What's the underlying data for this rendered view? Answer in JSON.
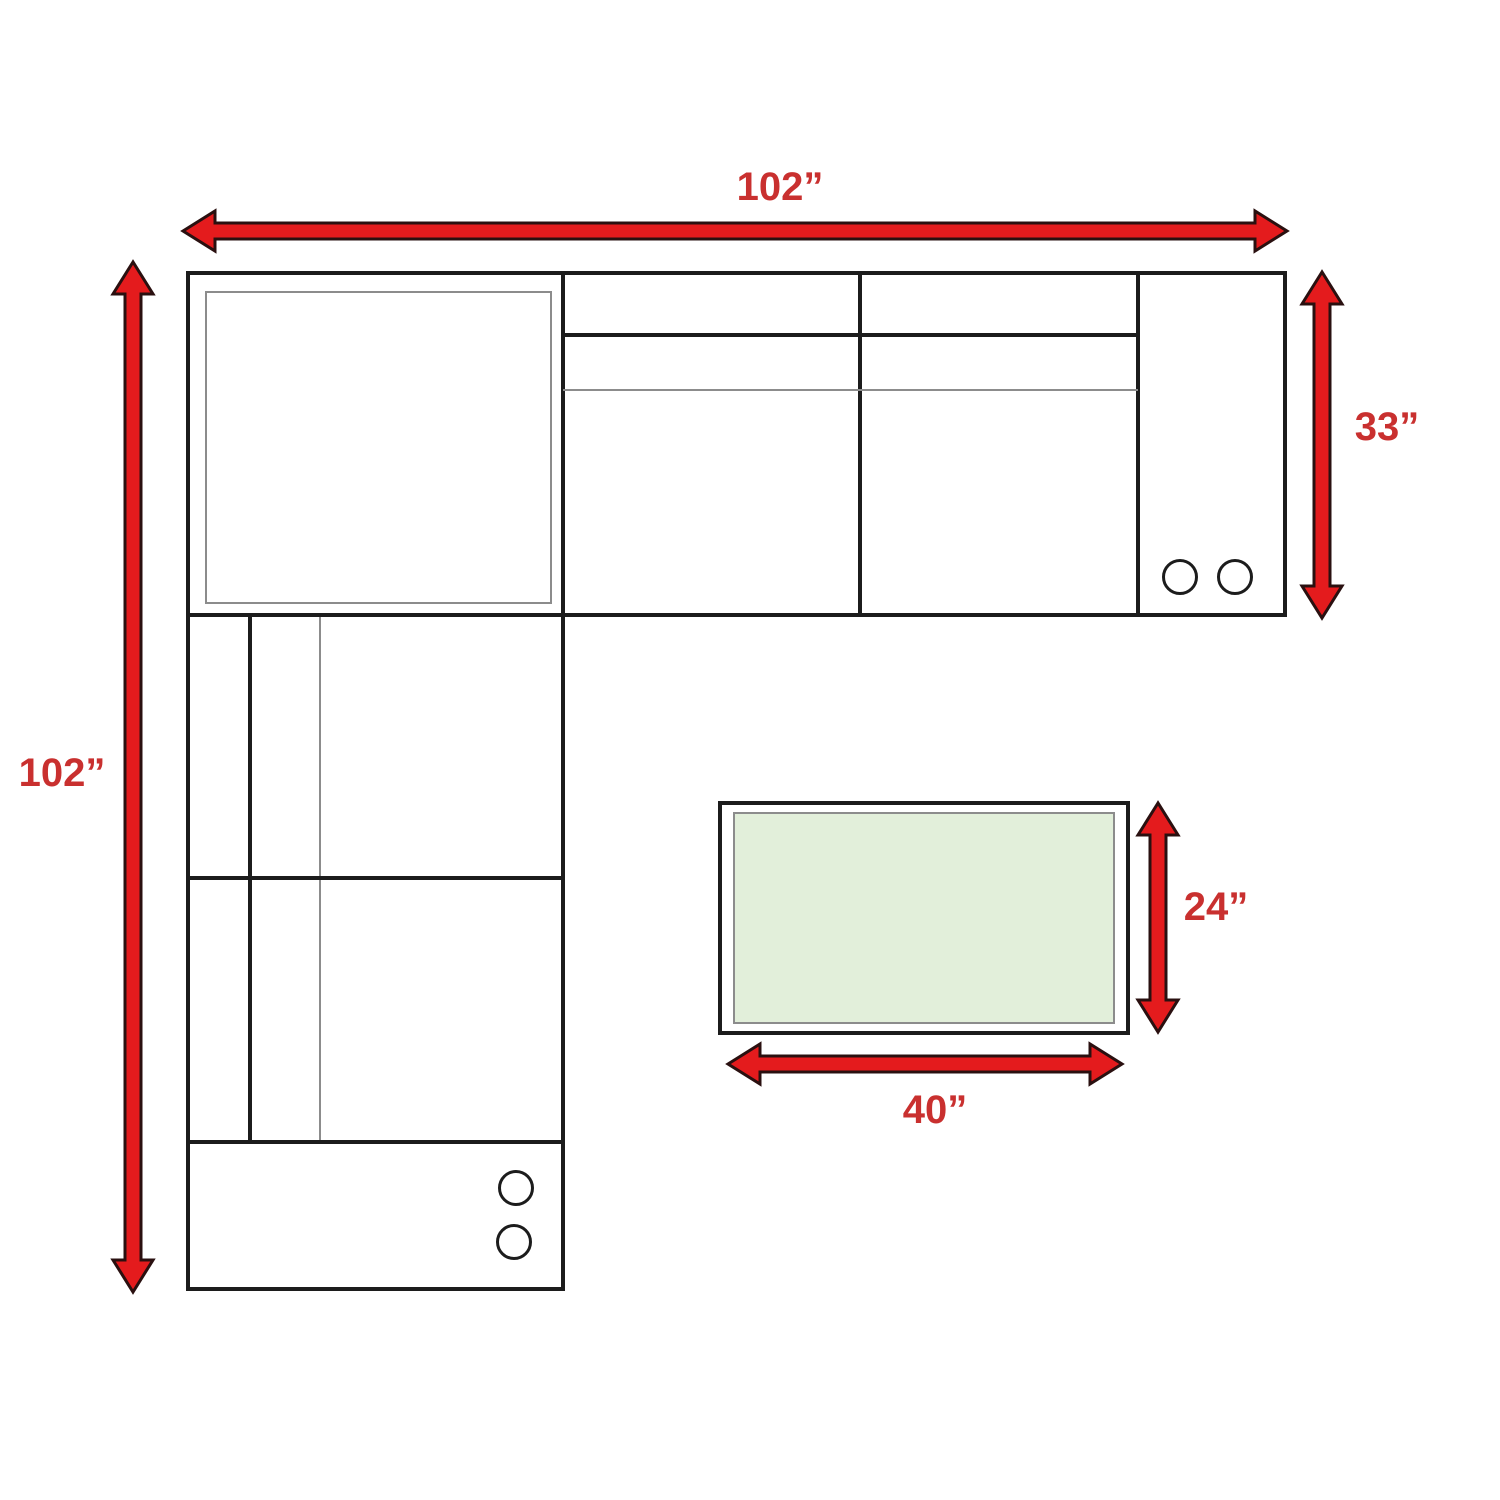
{
  "diagram": {
    "kind": "furniture-dimension-floor-plan",
    "subject": "L-shaped sectional sofa with cup-holder consoles and rectangular coffee table"
  },
  "colors": {
    "background": "#ffffff",
    "arrow_fill": "#e41b1d",
    "arrow_outline": "#2a1010",
    "label_text": "#c9302f",
    "outline_black": "#1c1c1c",
    "outline_gray": "#8c8c8c",
    "table_fill": "#e2efda"
  },
  "dimensions": {
    "sofa_width": {
      "label": "102”",
      "inches": 102
    },
    "sofa_depth": {
      "label": "102”",
      "inches": 102
    },
    "seat_depth": {
      "label": "33”",
      "inches": 33
    },
    "table_depth": {
      "label": "24”",
      "inches": 24
    },
    "table_width": {
      "label": "40”",
      "inches": 40
    }
  }
}
